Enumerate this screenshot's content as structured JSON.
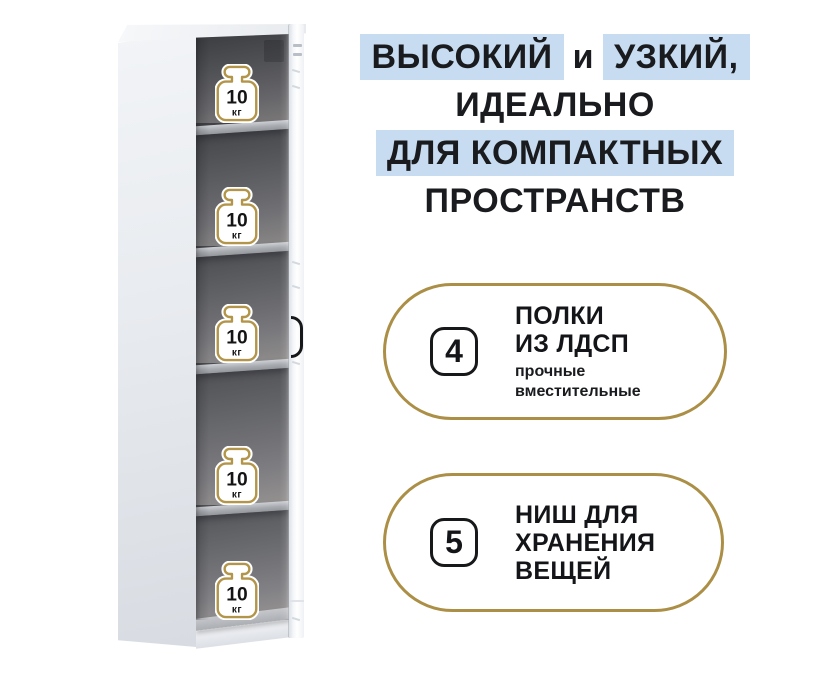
{
  "page": {
    "background": "#ffffff"
  },
  "colors": {
    "highlight_blue": "#c7dcf0",
    "badge_gold_border": "#ac8f46",
    "weight_icon_gold": "#b3954a",
    "text_dark": "#1a1b1e"
  },
  "headline": {
    "lines": [
      {
        "segments": [
          {
            "text": "ВЫСОКИЙ",
            "highlight": true
          },
          {
            "text": "и",
            "highlight": false
          },
          {
            "text": "УЗКИЙ,",
            "highlight": true
          }
        ]
      },
      {
        "segments": [
          {
            "text": "ИДЕАЛЬНО",
            "highlight": false
          }
        ]
      },
      {
        "segments": [
          {
            "text": "ДЛЯ КОМПАКТНЫХ",
            "highlight": true
          }
        ]
      },
      {
        "segments": [
          {
            "text": "ПРОСТРАНСТВ",
            "highlight": false
          }
        ]
      }
    ]
  },
  "features": [
    {
      "number": "4",
      "title_lines": [
        "ПОЛКИ",
        "ИЗ ЛДСП"
      ],
      "subtitle_lines": [
        "прочные",
        "вместительные"
      ]
    },
    {
      "number": "5",
      "title_lines": [
        "НИШ ДЛЯ",
        "ХРАНЕНИЯ",
        "ВЕЩЕЙ"
      ],
      "subtitle_lines": []
    }
  ],
  "cabinet": {
    "niche_count": 5,
    "weights": [
      {
        "value": "10",
        "unit": "кг"
      },
      {
        "value": "10",
        "unit": "кг"
      },
      {
        "value": "10",
        "unit": "кг"
      },
      {
        "value": "10",
        "unit": "кг"
      },
      {
        "value": "10",
        "unit": "кг"
      }
    ]
  }
}
